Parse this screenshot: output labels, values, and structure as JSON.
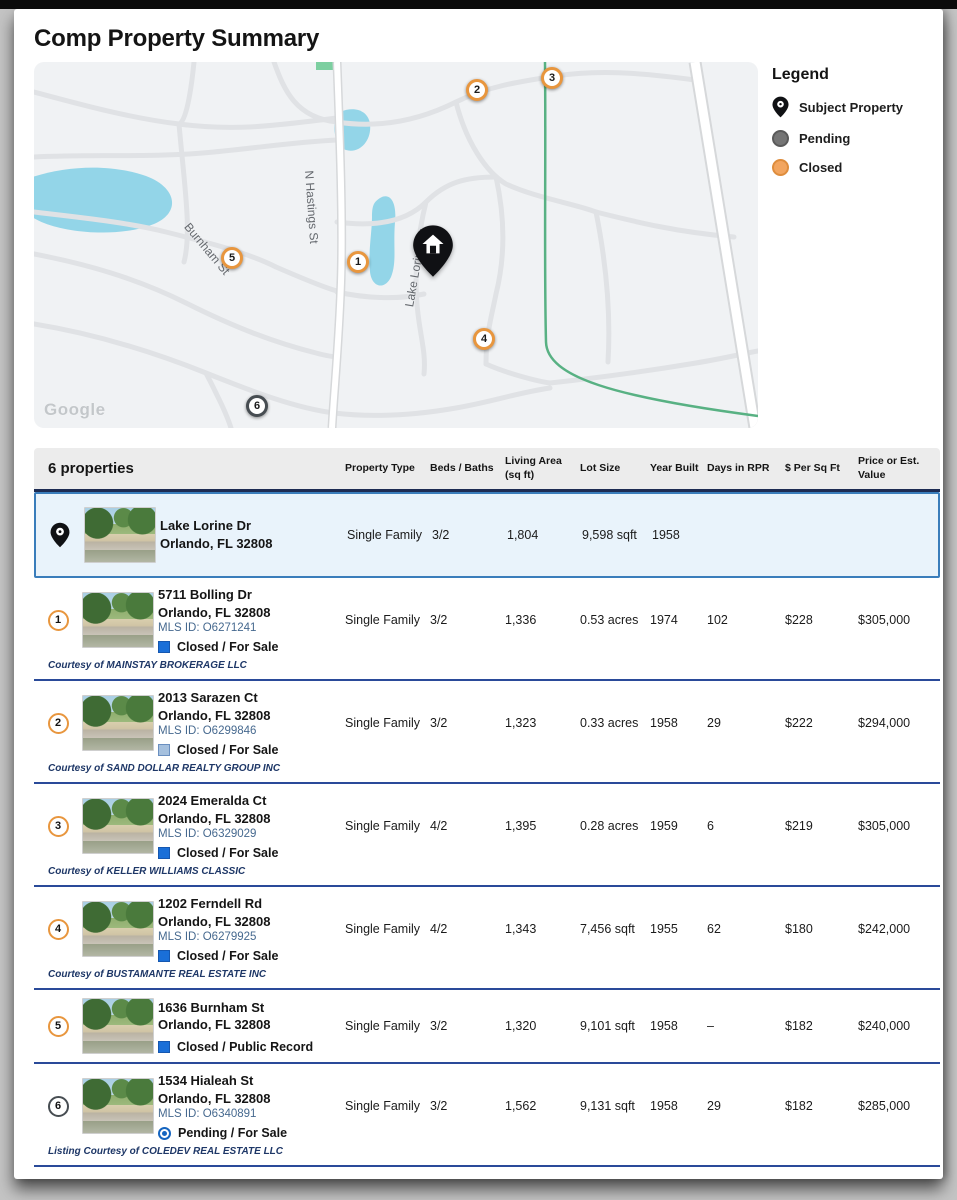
{
  "page": {
    "title": "Comp Property Summary"
  },
  "colors": {
    "divider": "#2a4a99",
    "header_rule": "#1d2b52",
    "subject_border": "#3a7dbb",
    "subject_bg": "#e9f3fb",
    "closed_blue": "#1a6fd8",
    "closed_blue_border": "#1557b0",
    "closed_light_blue": "#a5c0de",
    "closed_light_border": "#6a8fc0",
    "pending_blue": "#1565c0",
    "badge_orange": "#e8963e",
    "badge_dark": "#474d52"
  },
  "map": {
    "watermark": "Google",
    "street_labels": [
      {
        "text": "N Hastings St"
      },
      {
        "text": "Burnham St"
      },
      {
        "text": "Lake Lorine Dr"
      }
    ],
    "markers": [
      {
        "label": "1",
        "ring": "#e8963e"
      },
      {
        "label": "2",
        "ring": "#e8963e"
      },
      {
        "label": "3",
        "ring": "#e8963e"
      },
      {
        "label": "4",
        "ring": "#e8963e"
      },
      {
        "label": "5",
        "ring": "#e8963e"
      },
      {
        "label": "6",
        "ring": "#474d52"
      }
    ]
  },
  "legend": {
    "title": "Legend",
    "items": [
      {
        "label": "Subject Property"
      },
      {
        "label": "Pending",
        "color": "#757575",
        "ring": "#5a5a5a"
      },
      {
        "label": "Closed",
        "color": "#f2a55f",
        "ring": "#de8d3d"
      }
    ]
  },
  "table": {
    "count_label": "6 properties",
    "columns": [
      "Property Type",
      "Beds / Baths",
      "Living Area (sq ft)",
      "Lot Size",
      "Year Built",
      "Days in RPR",
      "$ Per Sq Ft",
      "Price or Est. Value"
    ],
    "subject": {
      "address": "Lake Lorine Dr",
      "city": "Orlando, FL 32808",
      "property_type": "Single Family",
      "beds_baths": "3/2",
      "living_area": "1,804",
      "lot_size": "9,598 sqft",
      "year_built": "1958",
      "days_in_rpr": "",
      "price_per_sqft": "",
      "price": ""
    },
    "rows": [
      {
        "num": "1",
        "badge_ring": "#e8963e",
        "address": "5711 Bolling Dr",
        "city": "Orlando, FL 32808",
        "mls": "MLS ID: O6271241",
        "status": "Closed / For Sale",
        "status_color": "#1a6fd8",
        "status_border": "#1557b0",
        "courtesy": "Courtesy of MAINSTAY BROKERAGE LLC",
        "property_type": "Single Family",
        "beds_baths": "3/2",
        "living_area": "1,336",
        "lot_size": "0.53 acres",
        "year_built": "1974",
        "days_in_rpr": "102",
        "price_per_sqft": "$228",
        "price": "$305,000"
      },
      {
        "num": "2",
        "badge_ring": "#e8963e",
        "address": "2013 Sarazen Ct",
        "city": "Orlando, FL 32808",
        "mls": "MLS ID: O6299846",
        "status": "Closed / For Sale",
        "status_color": "#a5c0de",
        "status_border": "#6a8fc0",
        "courtesy": "Courtesy of SAND DOLLAR REALTY GROUP INC",
        "property_type": "Single Family",
        "beds_baths": "3/2",
        "living_area": "1,323",
        "lot_size": "0.33 acres",
        "year_built": "1958",
        "days_in_rpr": "29",
        "price_per_sqft": "$222",
        "price": "$294,000"
      },
      {
        "num": "3",
        "badge_ring": "#e8963e",
        "address": "2024 Emeralda Ct",
        "city": "Orlando, FL 32808",
        "mls": "MLS ID: O6329029",
        "status": "Closed / For Sale",
        "status_color": "#1a6fd8",
        "status_border": "#1557b0",
        "courtesy": "Courtesy of KELLER WILLIAMS CLASSIC",
        "property_type": "Single Family",
        "beds_baths": "4/2",
        "living_area": "1,395",
        "lot_size": "0.28 acres",
        "year_built": "1959",
        "days_in_rpr": "6",
        "price_per_sqft": "$219",
        "price": "$305,000"
      },
      {
        "num": "4",
        "badge_ring": "#e8963e",
        "address": "1202 Ferndell Rd",
        "city": "Orlando, FL 32808",
        "mls": "MLS ID: O6279925",
        "status": "Closed / For Sale",
        "status_color": "#1a6fd8",
        "status_border": "#1557b0",
        "courtesy": "Courtesy of BUSTAMANTE REAL ESTATE INC",
        "property_type": "Single Family",
        "beds_baths": "4/2",
        "living_area": "1,343",
        "lot_size": "7,456 sqft",
        "year_built": "1955",
        "days_in_rpr": "62",
        "price_per_sqft": "$180",
        "price": "$242,000"
      },
      {
        "num": "5",
        "badge_ring": "#e8963e",
        "address": "1636 Burnham St",
        "city": "Orlando, FL 32808",
        "status": "Closed / Public Record",
        "status_color": "#1a6fd8",
        "status_border": "#1557b0",
        "property_type": "Single Family",
        "beds_baths": "3/2",
        "living_area": "1,320",
        "lot_size": "9,101 sqft",
        "year_built": "1958",
        "days_in_rpr": "–",
        "price_per_sqft": "$182",
        "price": "$240,000"
      },
      {
        "num": "6",
        "badge_ring": "#474d52",
        "address": "1534 Hialeah St",
        "city": "Orlando, FL 32808",
        "mls": "MLS ID: O6340891",
        "status": "Pending / For Sale",
        "status_color": "#1565c0",
        "courtesy": "Listing Courtesy of COLEDEV REAL ESTATE LLC",
        "property_type": "Single Family",
        "beds_baths": "3/2",
        "living_area": "1,562",
        "lot_size": "9,131 sqft",
        "year_built": "1958",
        "days_in_rpr": "29",
        "price_per_sqft": "$182",
        "price": "$285,000"
      }
    ]
  }
}
